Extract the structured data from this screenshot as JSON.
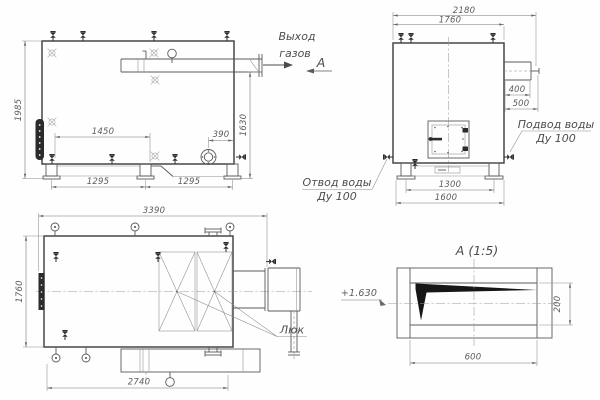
{
  "side_view": {
    "gas_outlet_line1": "Выход",
    "gas_outlet_line2": "газов",
    "section_mark": "А",
    "dim_height": "1985",
    "dim_flue_height": "1630",
    "dim_pump_span": "1450",
    "dim_burner_offset": "390",
    "dim_support_span_1": "1295",
    "dim_support_span_2": "1295"
  },
  "end_view": {
    "dim_overall_width": "2180",
    "dim_body_width": "1760",
    "dim_flue_w": "400",
    "dim_flue_d": "500",
    "dim_base_inner": "1300",
    "dim_base_outer": "1600",
    "water_inlet_line1": "Подвод воды",
    "water_inlet_line2": "Ду 100",
    "water_outlet_line1": "Отвод воды",
    "water_outlet_line2": "Ду 100"
  },
  "plan_view": {
    "dim_overall_length": "3390",
    "dim_body_width": "1760",
    "dim_base_length": "2740",
    "hatch_label": "Люк"
  },
  "detail_view": {
    "title": "А (1:5)",
    "elevation": "+1.630",
    "dim_width": "600",
    "dim_height": "200"
  }
}
